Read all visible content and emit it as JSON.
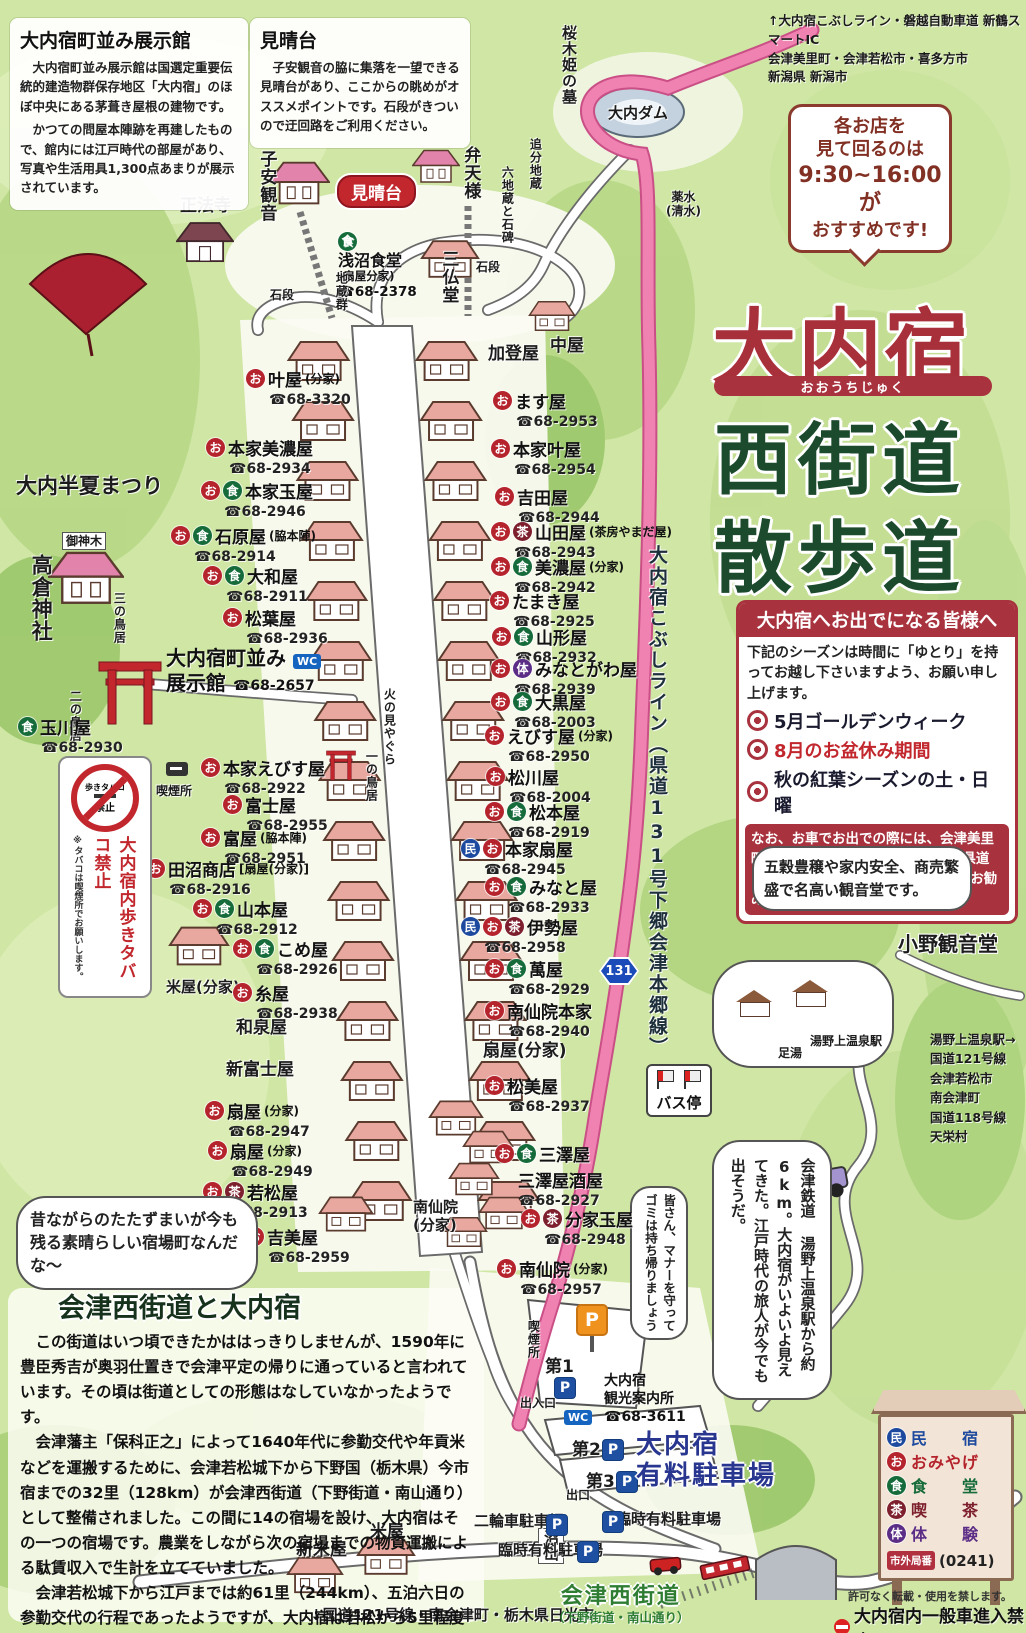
{
  "title": {
    "main": "大内宿",
    "furigana": "おおうちじゅく",
    "sub1": "西街道",
    "sub2": "散歩道"
  },
  "info_tenjikan": {
    "title": "大内宿町並み展示館",
    "para1": "　大内宿町並み展示館は国選定重要伝統的建造物群保存地区「大内宿」のほぼ中央にある茅葺き屋根の建物です。",
    "para2": "　かつての問屋本陣跡を再建したもので、館内には江戸時代の部屋があり、写真や生活用具1,300点あまりが展示されています。"
  },
  "info_miharashidai": {
    "title": "見晴台",
    "para": "　子安観音の脇に集落を一望できる見晴台があり、ここからの眺めがオススメポイントです。石段がきついので迂回路をご利用ください。"
  },
  "routes_top": {
    "line1": "↑大内宿こぶしライン・磐越自動車道 新鶴スマートIC",
    "line2": "会津美里町・会津若松市・喜多方市",
    "line3": "新潟県 新潟市"
  },
  "hours_bubble": {
    "line1": "各お店を",
    "line2": "見て回るのは",
    "line3": "9:30~16:00が",
    "line4": "おすすめです!"
  },
  "notice": {
    "header": "大内宿へお出でになる皆様へ",
    "intro": "下記のシーズンは時間に「ゆとり」を持ってお越し下さいますよう、お願い申し上げます。",
    "items": [
      {
        "text": "5月ゴールデンウィーク",
        "color": "#1a1a2e"
      },
      {
        "text": "8月のお盆休み期間",
        "color": "#c1272d"
      },
      {
        "text": "秋の紅葉シーズンの土・日曜",
        "color": "#1a1a2e"
      }
    ],
    "footer": "なお、お車でお出での際には、会津美里町方面から“大内宿こぶしライン（県道131号下郷会津本郷線）”のご利用をお勧めいたします。"
  },
  "kannon_bubble": "五穀豊穣や家内安全、商売繁盛で名高い観音堂です。",
  "station_note": {
    "lines": [
      "湯野上温泉駅→",
      "国道121号線",
      "会津若松市",
      "南会津町",
      "国道118号線",
      "天栄村"
    ]
  },
  "drive_bubble": "会津鉄道 湯野上温泉駅から約6km。大内宿がいよいよ見えてきた。江戸時代の旅人が今でも出そうだ。",
  "manner_bubble": "皆さん、マナーを守ってゴミは持ち帰りましょう",
  "nostalgia_bubble": "昔ながらのたたずまいが今も残る素晴らしい宿場町なんだな〜",
  "no_smoking": {
    "circle_top": "歩きタバコ",
    "circle_bottom": "禁止",
    "main": "大内宿内歩きタバコ禁止",
    "note": "※タバコは喫煙所でお願いします。"
  },
  "history": {
    "title": "会津西街道と大内宿",
    "para1": "　この街道はいつ頃できたかははっきりしませんが、1590年に豊臣秀吉が奥羽仕置きで会津平定の帰りに通っていると言われています。その頃は街道としての形態はなしていなかったようです。",
    "para2": "　会津藩主「保科正之」によって1640年代に参勤交代や年貢米などを運搬するために、会津若松城下から下野国（栃木県）今市宿までの32里（128km）が会津西街道（下野街道・南山通り）として整備されました。この間に14の宿場を設け、大内宿はその一つの宿場です。農業をしながら次の宿場までの物資運搬による駄賃収入で生計を立てていました。",
    "para3": "　会津若松城下から江戸までは約61里（244km）、五泊六日の参勤交代の行程であったようですが、大内宿は若松から5里程度で、早朝に城を出た大名行列の昼食休憩の宿場でした。",
    "para4": "　大内宿の各家庭には屋号があり、現在も屋号で呼び合う習慣が引き継がれています。"
  },
  "legend": {
    "items": [
      {
        "mark": "民",
        "color": "#1d4a9e",
        "label": "民　　宿"
      },
      {
        "mark": "お",
        "color": "#b5232d",
        "label": "おみやげ"
      },
      {
        "mark": "食",
        "color": "#156b3a",
        "label": "食　　堂"
      },
      {
        "mark": "茶",
        "color": "#7d1f2d",
        "label": "喫　　茶"
      },
      {
        "mark": "体",
        "color": "#5c2d86",
        "label": "体　　験"
      }
    ],
    "area_badge": "市外局番",
    "area_num": "(0241)",
    "note1": "許可なく転載・使用を禁します。",
    "note2": "大内宿内一般車進入禁止"
  },
  "icon_colors": {
    "お": "#b5232d",
    "食": "#156b3a",
    "茶": "#7d1f2d",
    "民": "#1d4a9e",
    "体": "#5c2d86"
  },
  "ex_hall": {
    "line1": "大内宿町並み",
    "line2": "展示館",
    "tel": "☎68-2657",
    "wc": "WC"
  },
  "asanuma": {
    "icon": "食",
    "name": "浅沼食堂",
    "sub": "(扇屋分家)",
    "tel": "☎68-2378"
  },
  "miharashi_badge": "見晴台",
  "annaijo": {
    "line1": "大内宿",
    "line2": "観光案内所",
    "tel": "☎68-3611"
  },
  "bus_stop": "バス停",
  "route_shield": "131",
  "kobushi_road": "大内宿こぶしライン（県道131号下郷会津本郷線）",
  "parking_big": {
    "line1": "大内宿",
    "line2": "有料駐車場"
  },
  "aizu_kaido": {
    "main": "会津西街道",
    "sub": "（下野街道・南山通り）"
  },
  "p_letter": "P",
  "labels": [
    {
      "text": "桜木姫の墓",
      "x": 560,
      "y": 25,
      "cls": "v md"
    },
    {
      "text": "大内ダム",
      "x": 608,
      "y": 104,
      "cls": "md"
    },
    {
      "text": "追分地蔵",
      "x": 528,
      "y": 138,
      "cls": "v sm"
    },
    {
      "text": "六地蔵と石碑",
      "x": 500,
      "y": 166,
      "cls": "v sm"
    },
    {
      "text": "薬水\n(清水)",
      "x": 666,
      "y": 190,
      "cls": "sm center"
    },
    {
      "text": "正法寺",
      "x": 180,
      "y": 196,
      "cls": "lg"
    },
    {
      "text": "子安観音",
      "x": 256,
      "y": 150,
      "cls": "v lg"
    },
    {
      "text": "弁天様",
      "x": 460,
      "y": 146,
      "cls": "v lg"
    },
    {
      "text": "三仏堂",
      "x": 438,
      "y": 250,
      "cls": "v lg"
    },
    {
      "text": "石段",
      "x": 270,
      "y": 288,
      "cls": "sm"
    },
    {
      "text": "石段",
      "x": 476,
      "y": 260,
      "cls": "sm"
    },
    {
      "text": "地蔵群",
      "x": 334,
      "y": 272,
      "cls": "v sm"
    },
    {
      "text": "加登屋",
      "x": 488,
      "y": 344,
      "cls": "lg"
    },
    {
      "text": "中屋",
      "x": 550,
      "y": 336,
      "cls": "lg"
    },
    {
      "text": "火の見やぐら",
      "x": 382,
      "y": 688,
      "cls": "v sm"
    },
    {
      "text": "一の鳥居",
      "x": 364,
      "y": 750,
      "cls": "v sm"
    },
    {
      "text": "大内半夏まつり",
      "x": 16,
      "y": 474,
      "cls": "xl"
    },
    {
      "text": "高倉神社",
      "x": 28,
      "y": 554,
      "cls": "v xl"
    },
    {
      "text": "御神木",
      "x": 62,
      "y": 532,
      "cls": "sm box"
    },
    {
      "text": "三の鳥居",
      "x": 112,
      "y": 592,
      "cls": "v sm"
    },
    {
      "text": "二の鳥居",
      "x": 68,
      "y": 690,
      "cls": "v sm"
    },
    {
      "text": "喫煙所",
      "x": 156,
      "y": 784,
      "cls": "sm"
    },
    {
      "text": "米屋(分家)",
      "x": 166,
      "y": 978,
      "cls": "md"
    },
    {
      "text": "和泉屋",
      "x": 236,
      "y": 1018,
      "cls": "lg"
    },
    {
      "text": "新富士屋",
      "x": 226,
      "y": 1060,
      "cls": "lg"
    },
    {
      "text": "扇屋(分家)",
      "x": 483,
      "y": 1041,
      "cls": "lg"
    },
    {
      "text": "南仙院\n(分家)",
      "x": 413,
      "y": 1198,
      "cls": "md"
    },
    {
      "text": "新米屋",
      "x": 296,
      "y": 1540,
      "cls": "lg"
    },
    {
      "text": "米屋",
      "x": 370,
      "y": 1522,
      "cls": "lg"
    },
    {
      "text": "沼山",
      "x": 538,
      "y": 1528,
      "cls": "v md box"
    },
    {
      "text": "出入口",
      "x": 520,
      "y": 1396,
      "cls": "sm"
    },
    {
      "text": "出口",
      "x": 566,
      "y": 1488,
      "cls": "sm"
    },
    {
      "text": "二輪車駐車場",
      "x": 474,
      "y": 1512,
      "cls": "md"
    },
    {
      "text": "臨時有料駐車場",
      "x": 498,
      "y": 1541,
      "cls": "md"
    },
    {
      "text": "臨時有料駐車場",
      "x": 616,
      "y": 1510,
      "cls": "md"
    },
    {
      "text": "喫煙所",
      "x": 526,
      "y": 1320,
      "cls": "v sm"
    },
    {
      "text": "小野観音堂",
      "x": 898,
      "y": 932,
      "cls": "xl outline"
    },
    {
      "text": "足湯",
      "x": 778,
      "y": 1046,
      "cls": "sm"
    },
    {
      "text": "湯野上温泉駅",
      "x": 810,
      "y": 1034,
      "cls": "sm"
    },
    {
      "text": "第1",
      "x": 545,
      "y": 1357,
      "cls": "lg"
    },
    {
      "text": "第2",
      "x": 572,
      "y": 1440,
      "cls": "lg"
    },
    {
      "text": "第3",
      "x": 586,
      "y": 1472,
      "cls": "lg"
    },
    {
      "text": "↓国道121号線・南会津町・栃木県日光市",
      "x": 310,
      "y": 1606,
      "cls": "md"
    }
  ],
  "shops_left": [
    {
      "x": 246,
      "y": 366,
      "icons": [
        "お"
      ],
      "name": "叶屋",
      "sub": "(分家)",
      "tel": "68-3320"
    },
    {
      "x": 206,
      "y": 435,
      "icons": [
        "お"
      ],
      "name": "本家美濃屋",
      "tel": "68-2934"
    },
    {
      "x": 201,
      "y": 478,
      "icons": [
        "お",
        "食"
      ],
      "name": "本家玉屋",
      "tel": "68-2946"
    },
    {
      "x": 171,
      "y": 523,
      "icons": [
        "お",
        "食"
      ],
      "name": "石原屋",
      "sub": "(脇本陣)",
      "tel": "68-2914"
    },
    {
      "x": 203,
      "y": 563,
      "icons": [
        "お",
        "食"
      ],
      "name": "大和屋",
      "tel": "68-2911"
    },
    {
      "x": 223,
      "y": 605,
      "icons": [
        "お"
      ],
      "name": "松葉屋",
      "tel": "68-2936"
    },
    {
      "x": 18,
      "y": 714,
      "icons": [
        "食"
      ],
      "name": "玉川屋",
      "tel": "68-2930"
    },
    {
      "x": 201,
      "y": 755,
      "icons": [
        "お"
      ],
      "name": "本家えびす屋",
      "tel": "68-2922"
    },
    {
      "x": 223,
      "y": 792,
      "icons": [
        "お"
      ],
      "name": "富士屋",
      "tel": "68-2955"
    },
    {
      "x": 201,
      "y": 825,
      "icons": [
        "お"
      ],
      "name": "富屋",
      "sub": "(脇本陣)",
      "tel": "68-2951"
    },
    {
      "x": 146,
      "y": 856,
      "icons": [
        "お"
      ],
      "name": "田沼商店",
      "sub": "[扇屋(分家)]",
      "tel": "68-2916"
    },
    {
      "x": 193,
      "y": 896,
      "icons": [
        "お",
        "食"
      ],
      "name": "山本屋",
      "tel": "68-2912"
    },
    {
      "x": 233,
      "y": 936,
      "icons": [
        "お",
        "食"
      ],
      "name": "こめ屋",
      "tel": "68-2926"
    },
    {
      "x": 233,
      "y": 980,
      "icons": [
        "お"
      ],
      "name": "糸屋",
      "tel": "68-2938"
    },
    {
      "x": 205,
      "y": 1098,
      "icons": [
        "お"
      ],
      "name": "扇屋",
      "sub": "(分家)",
      "tel": "68-2947"
    },
    {
      "x": 208,
      "y": 1138,
      "icons": [
        "お"
      ],
      "name": "扇屋",
      "sub": "(分家)",
      "tel": "68-2949"
    },
    {
      "x": 203,
      "y": 1179,
      "icons": [
        "お",
        "茶"
      ],
      "name": "若松屋",
      "tel": "68-2913"
    },
    {
      "x": 245,
      "y": 1224,
      "icons": [
        "お"
      ],
      "name": "吉美屋",
      "tel": "68-2959"
    }
  ],
  "shops_right": [
    {
      "x": 493,
      "y": 388,
      "icons": [
        "お"
      ],
      "name": "ます屋",
      "tel": "68-2953"
    },
    {
      "x": 491,
      "y": 436,
      "icons": [
        "お"
      ],
      "name": "本家叶屋",
      "tel": "68-2954"
    },
    {
      "x": 495,
      "y": 484,
      "icons": [
        "お"
      ],
      "name": "吉田屋",
      "tel": "68-2944"
    },
    {
      "x": 491,
      "y": 519,
      "icons": [
        "お",
        "茶"
      ],
      "name": "山田屋",
      "sub": "(茶房やまだ屋)",
      "tel": "68-2943"
    },
    {
      "x": 491,
      "y": 554,
      "icons": [
        "お",
        "食"
      ],
      "name": "美濃屋",
      "sub": "(分家)",
      "tel": "68-2942"
    },
    {
      "x": 490,
      "y": 588,
      "icons": [
        "お"
      ],
      "name": "たまき屋",
      "tel": "68-2925"
    },
    {
      "x": 492,
      "y": 624,
      "icons": [
        "お",
        "食"
      ],
      "name": "山形屋",
      "tel": "68-2932"
    },
    {
      "x": 491,
      "y": 656,
      "icons": [
        "お",
        "体"
      ],
      "name": "みなとがわ屋",
      "tel": "68-2939"
    },
    {
      "x": 491,
      "y": 689,
      "icons": [
        "お",
        "食"
      ],
      "name": "大黒屋",
      "tel": "68-2003"
    },
    {
      "x": 485,
      "y": 723,
      "icons": [
        "お"
      ],
      "name": "えびす屋",
      "sub": "(分家)",
      "tel": "68-2950"
    },
    {
      "x": 486,
      "y": 764,
      "icons": [
        "お"
      ],
      "name": "松川屋",
      "tel": "68-2004"
    },
    {
      "x": 485,
      "y": 799,
      "icons": [
        "お",
        "食"
      ],
      "name": "松本屋",
      "tel": "68-2919"
    },
    {
      "x": 461,
      "y": 836,
      "icons": [
        "民",
        "お"
      ],
      "name": "本家扇屋",
      "tel": "68-2945"
    },
    {
      "x": 485,
      "y": 874,
      "icons": [
        "お",
        "食"
      ],
      "name": "みなと屋",
      "tel": "68-2933"
    },
    {
      "x": 461,
      "y": 914,
      "icons": [
        "民",
        "お",
        "茶"
      ],
      "name": "伊勢屋",
      "tel": "68-2958"
    },
    {
      "x": 485,
      "y": 956,
      "icons": [
        "お",
        "食"
      ],
      "name": "萬屋",
      "tel": "68-2929"
    },
    {
      "x": 485,
      "y": 998,
      "icons": [
        "お"
      ],
      "name": "南仙院本家",
      "tel": "68-2940"
    },
    {
      "x": 485,
      "y": 1073,
      "icons": [
        "お"
      ],
      "name": "松美屋",
      "tel": "68-2937"
    },
    {
      "x": 495,
      "y": 1141,
      "icons": [
        "お",
        "食"
      ],
      "name": "三澤屋",
      "name2": "三澤屋酒屋",
      "tel": "68-2927"
    },
    {
      "x": 521,
      "y": 1206,
      "icons": [
        "お",
        "茶"
      ],
      "name": "分家玉屋",
      "tel": "68-2948"
    },
    {
      "x": 497,
      "y": 1256,
      "icons": [
        "お"
      ],
      "name": "南仙院",
      "sub": "(分家)",
      "tel": "68-2957"
    }
  ],
  "p_marks": [
    [
      554,
      1377
    ],
    [
      602,
      1439
    ],
    [
      616,
      1471
    ],
    [
      546,
      1514
    ],
    [
      577,
      1541
    ],
    [
      602,
      1511
    ]
  ],
  "wc_marks": [
    [
      564,
      1410
    ]
  ]
}
